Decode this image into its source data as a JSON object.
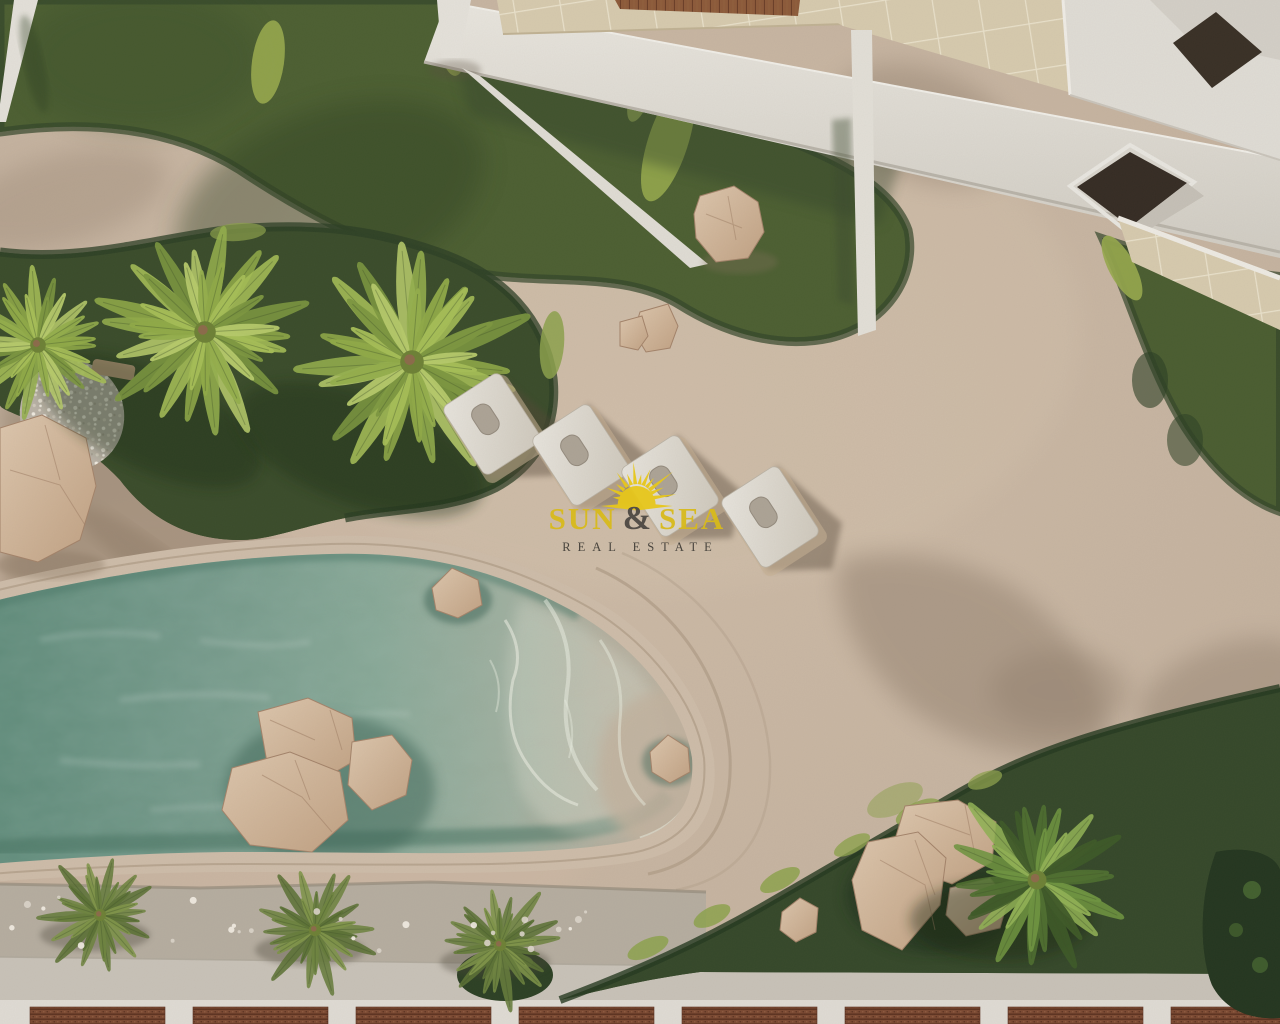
{
  "watermark": {
    "brand_pre": "SUN",
    "brand_amp": "&",
    "brand_post": "SEA",
    "tagline": "REAL ESTATE",
    "sun_color": "#E7C71B",
    "brand_color": "#D8BA1C",
    "amp_color": "#4E4943",
    "tagline_color": "#433F39"
  },
  "scene": {
    "type": "aerial-3d-architectural-render",
    "subject": "resort courtyard with lagoon-style pool, sun deck and gardens",
    "sun_loungers_count": 4,
    "large_palms_count": 3,
    "walkway_palms_count": 3,
    "garden_palms_count": 1,
    "palette": {
      "sand_deck": "#C8B6A2",
      "pool_water": "#7FA392",
      "pool_shallow": "#BBAE9C",
      "lawn": "#4C5F32",
      "hedge": "#35482A",
      "building_white": "#E3E0D9",
      "terrace_tile": "#D5C9AC",
      "deck_wood": "#8C5A3A",
      "rock": "#CDB193",
      "pergola_wood": "#7C4A33",
      "pebble_strip": "#B5ADA0"
    }
  }
}
